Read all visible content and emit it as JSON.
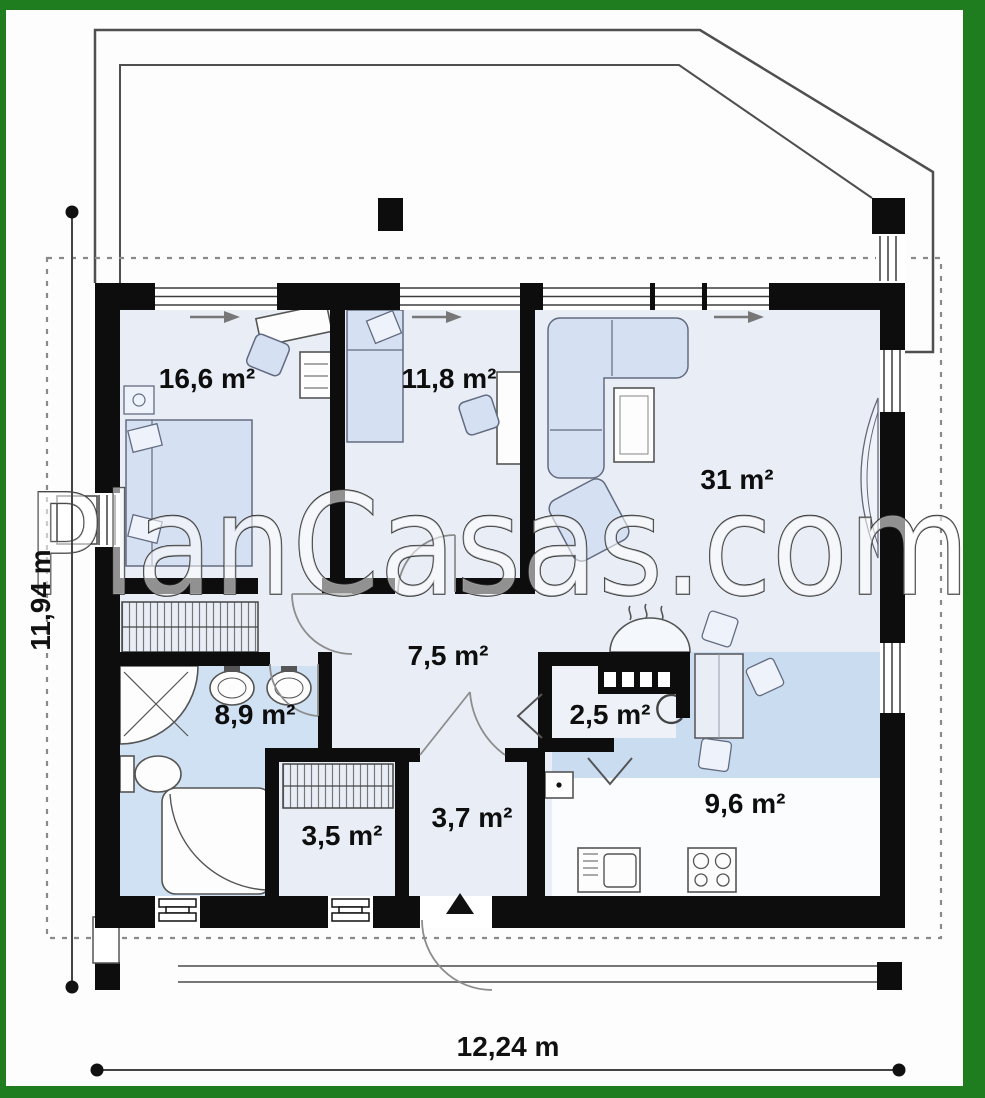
{
  "watermark": {
    "text": "PlanCasas.com"
  },
  "dimensions": {
    "width_label": "12,24 m",
    "height_label": "11,94 m"
  },
  "rooms": {
    "bedroom1": {
      "name": "bedroom-1",
      "area": "16,6 m²"
    },
    "bedroom2": {
      "name": "bedroom-2",
      "area": "11,8 m²"
    },
    "living": {
      "name": "living-room",
      "area": "31 m²"
    },
    "hall": {
      "name": "hall",
      "area": "7,5 m²"
    },
    "bathroom": {
      "name": "bathroom",
      "area": "8,9 m²"
    },
    "pantry": {
      "name": "pantry",
      "area": "2,5 m²"
    },
    "kitchen": {
      "name": "kitchen",
      "area": "9,6 m²"
    },
    "closet": {
      "name": "closet",
      "area": "3,5 m²"
    },
    "entry": {
      "name": "entry",
      "area": "3,7 m²"
    }
  },
  "colors": {
    "frame_green": "#1f7d1f",
    "wall_black": "#0d0d0d",
    "room_fill": "#e9eef6",
    "bathroom_fill": "#cfe1f3",
    "kitchen_floor": "#c9dcf0",
    "furniture_fill": "#d5e0f2"
  }
}
